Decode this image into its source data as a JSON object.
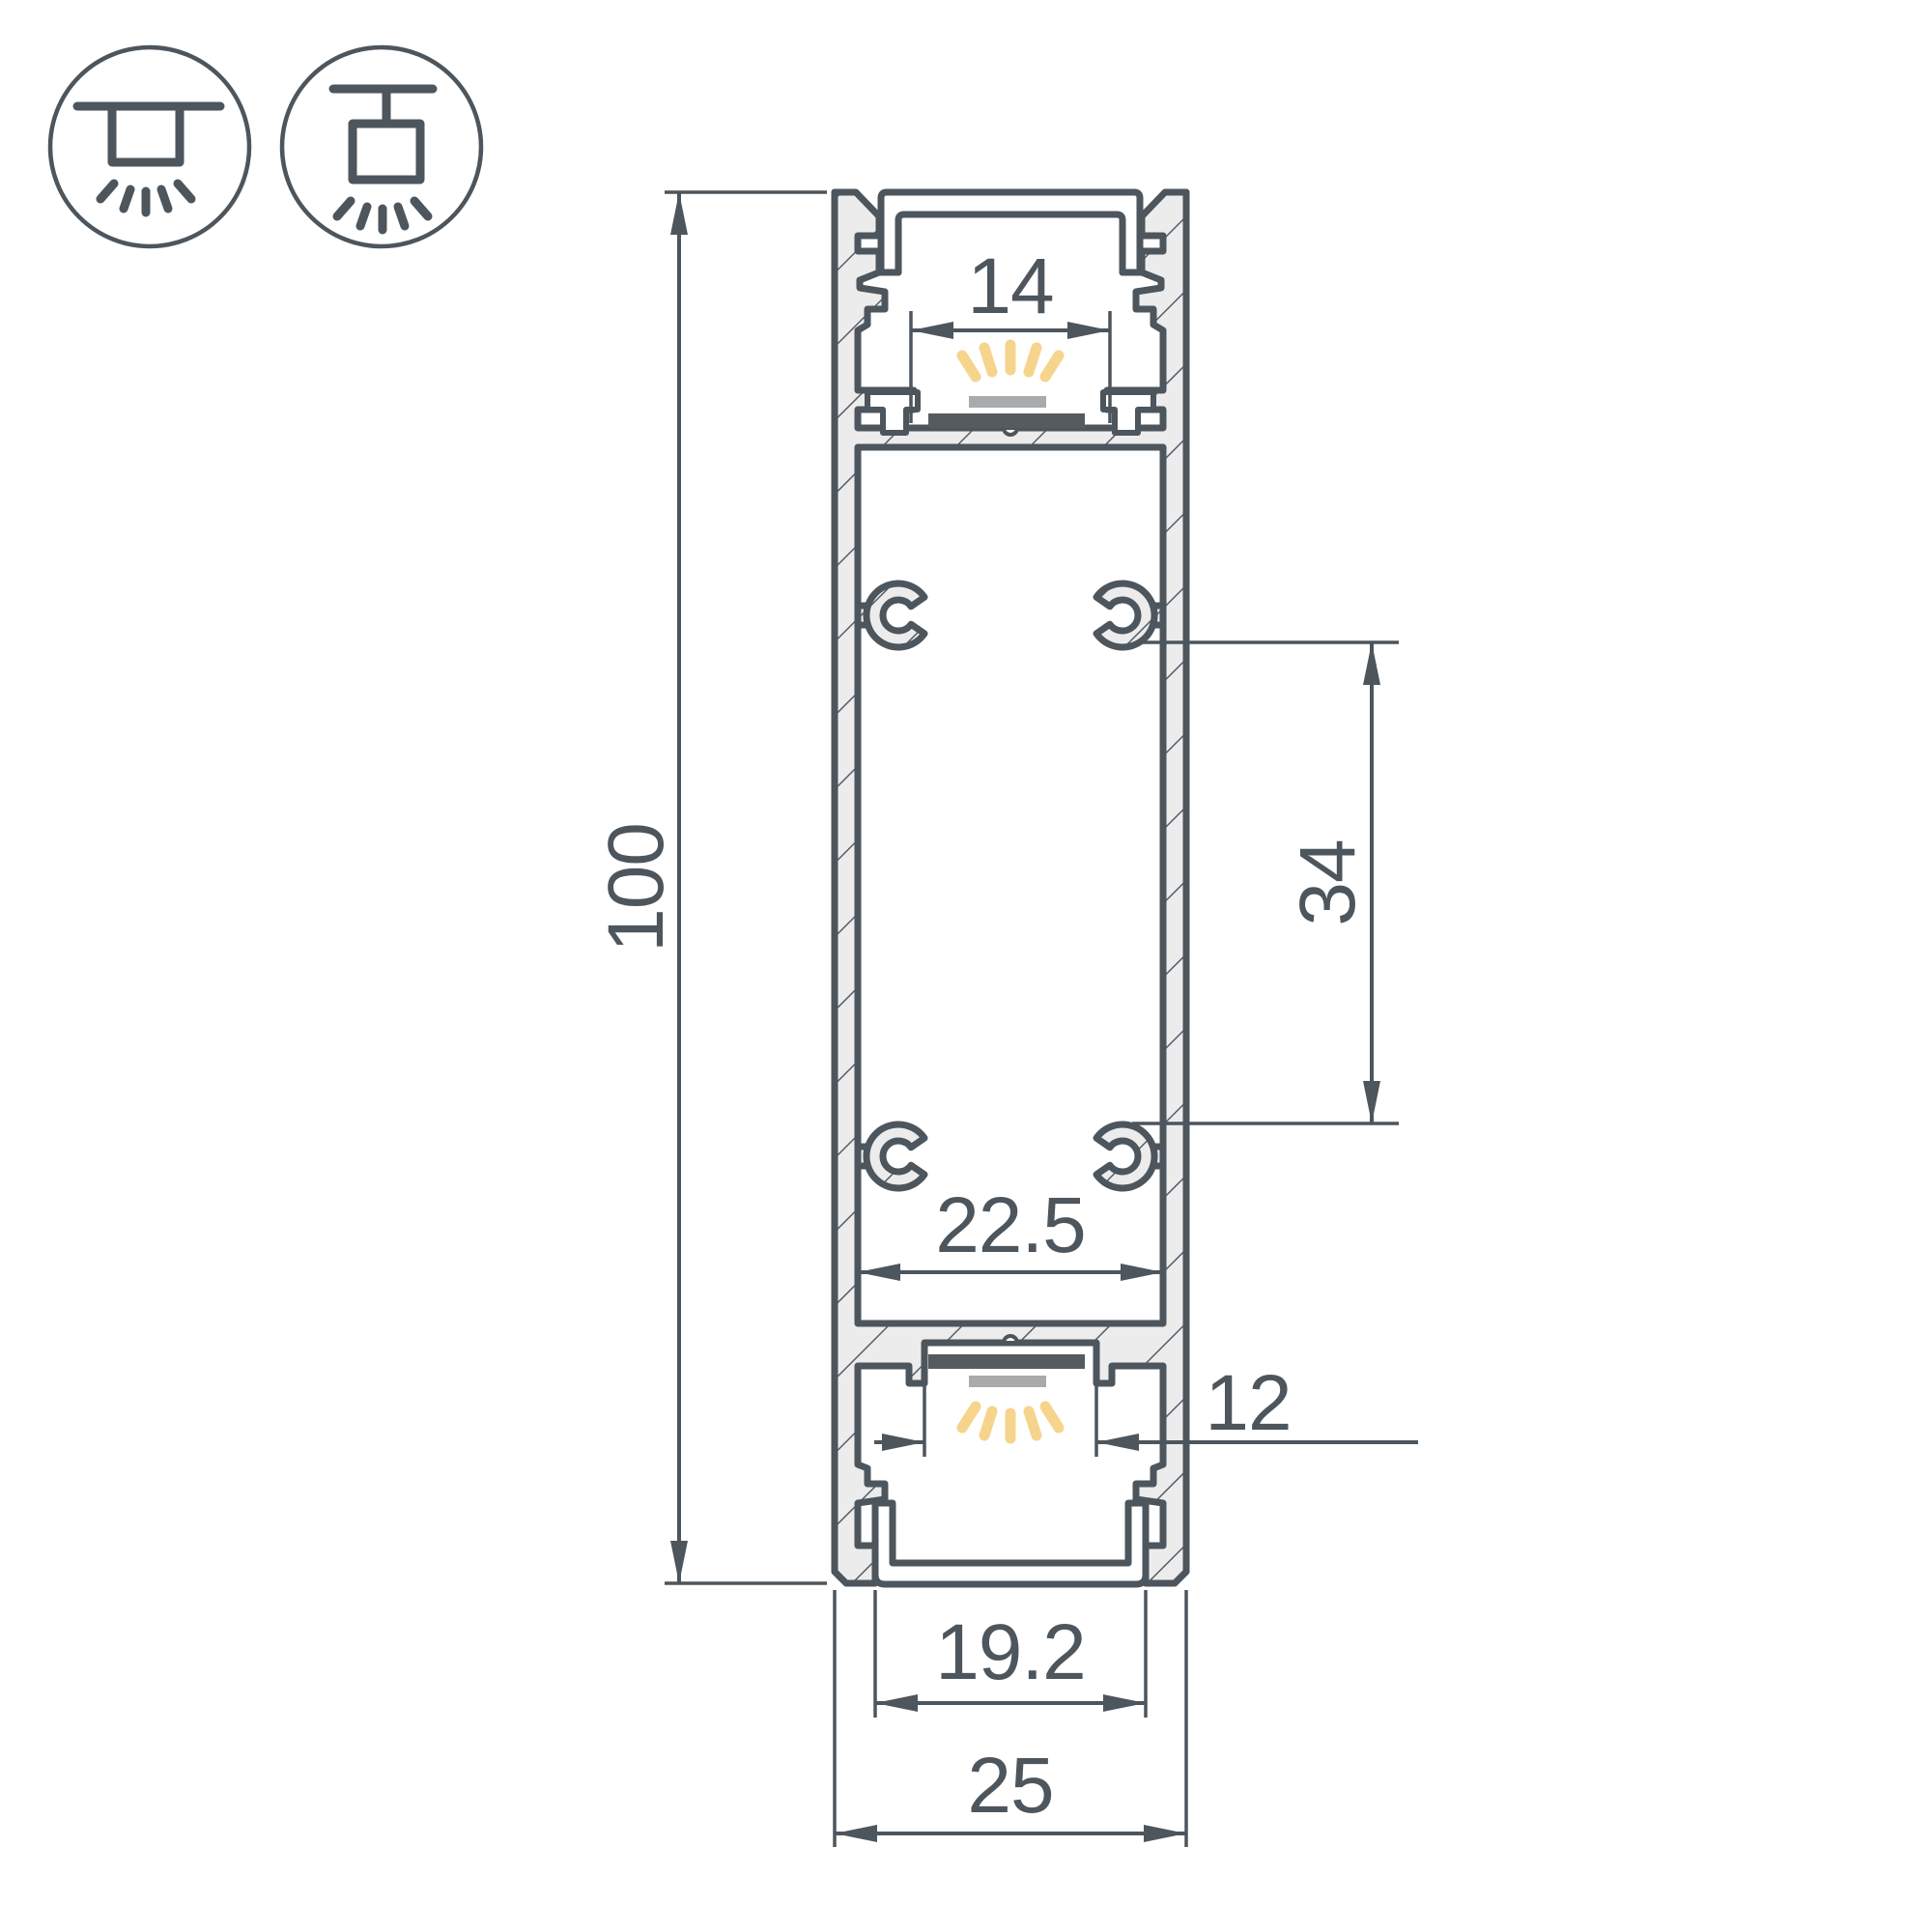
{
  "drawing": {
    "kind": "led-profile-cross-section"
  },
  "icons": {
    "surface_mount": {
      "name": "surface-ceiling-mount"
    },
    "pendant_mount": {
      "name": "pendant-suspension-mount"
    }
  },
  "dimensions": {
    "overall_height": {
      "value": "100"
    },
    "top_opening_width": {
      "value": "14"
    },
    "screw_boss_spacing": {
      "value": "34"
    },
    "inner_cavity_width": {
      "value": "22.5"
    },
    "bottom_led_opening": {
      "value": "12"
    },
    "diffuser_opening_width": {
      "value": "19.2"
    },
    "overall_width": {
      "value": "25"
    }
  },
  "colors": {
    "line": "#4d555d",
    "hatch_fill": "#ececec",
    "led_glow": "#f6d48c",
    "led_bar": "#a8aaab",
    "pcb": "#565b60",
    "background": "#ffffff"
  }
}
